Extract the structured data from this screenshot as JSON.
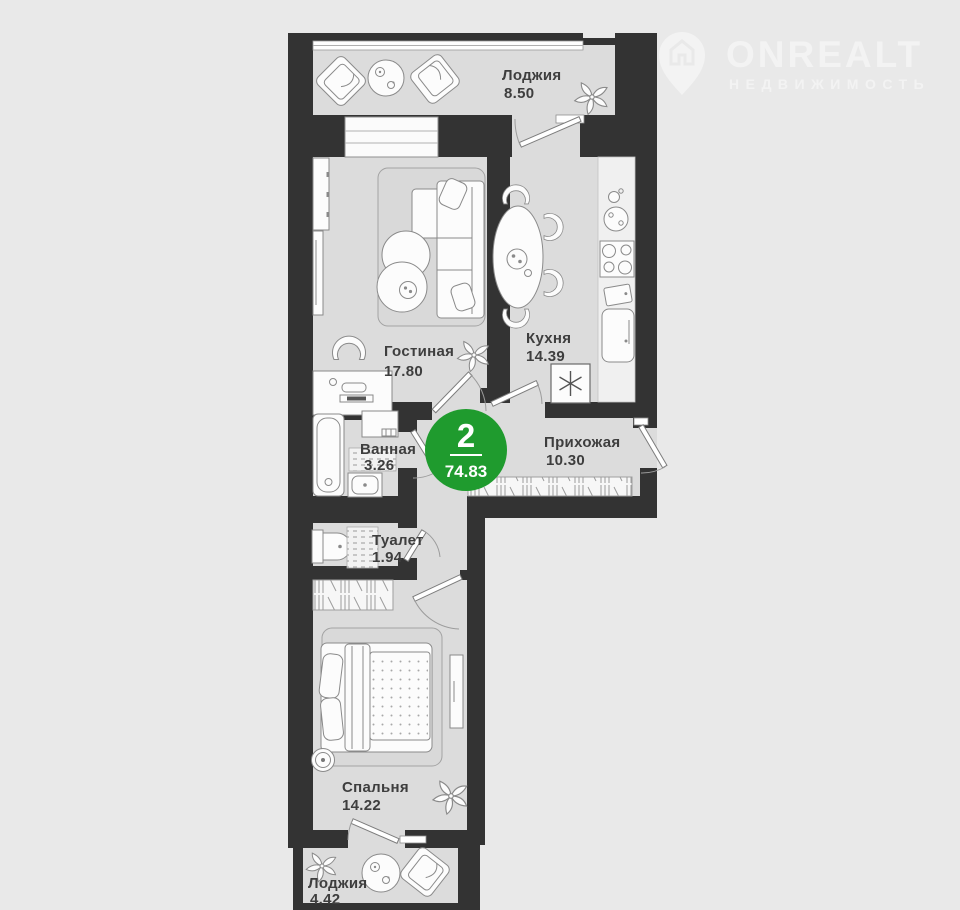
{
  "logo": {
    "brand": "ONREALT",
    "tagline": "НЕДВИЖИМОСТЬ",
    "icon": "house-pin-icon"
  },
  "badge": {
    "rooms_count": "2",
    "total_area": "74.83",
    "color": "#1f9b2e"
  },
  "rooms": [
    {
      "id": "loggia-top",
      "name": "Лоджия",
      "area": "8.50"
    },
    {
      "id": "living-room",
      "name": "Гостиная",
      "area": "17.80"
    },
    {
      "id": "kitchen",
      "name": "Кухня",
      "area": "14.39"
    },
    {
      "id": "bathroom",
      "name": "Ванная",
      "area": "3.26"
    },
    {
      "id": "hallway",
      "name": "Прихожая",
      "area": "10.30"
    },
    {
      "id": "toilet",
      "name": "Туалет",
      "area": "1.94"
    },
    {
      "id": "bedroom",
      "name": "Спальня",
      "area": "14.22"
    },
    {
      "id": "loggia-bottom",
      "name": "Лоджия",
      "area": "4.42"
    }
  ],
  "colors": {
    "accent_green": "#1f9b2e",
    "wall": "#333333",
    "floor": "#dcdcdc",
    "background": "#e9e9e9"
  }
}
